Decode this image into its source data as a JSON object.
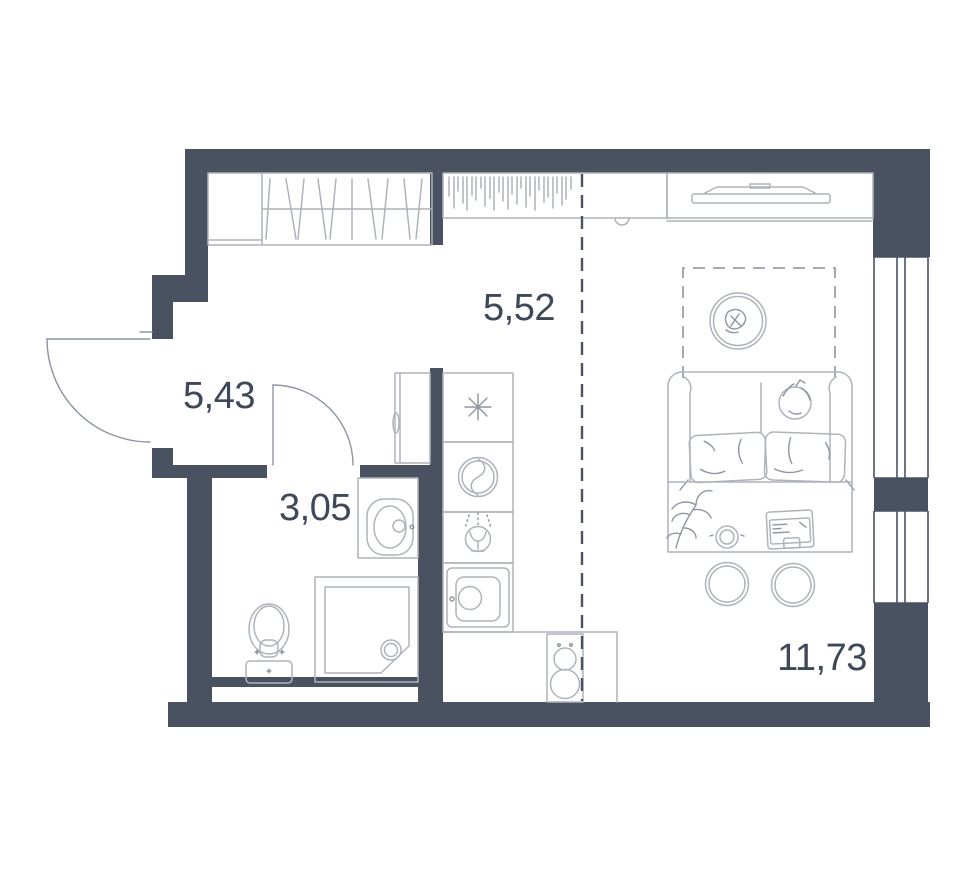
{
  "plan": {
    "type": "apartment-floor-plan",
    "colors": {
      "wall": "#4a5262",
      "furniture_line": "#aeb3ba",
      "furniture_line_dark": "#8e95a0",
      "partition_dash": "#4a5262",
      "rug_dash": "#9aa0ab",
      "label": "#3f4859",
      "background": "#ffffff"
    },
    "rooms": [
      {
        "id": "hallway",
        "area_label": "5,43"
      },
      {
        "id": "bathroom",
        "area_label": "3,05"
      },
      {
        "id": "kitchen",
        "area_label": "5,52"
      },
      {
        "id": "living-room",
        "area_label": "11,73"
      }
    ],
    "fixtures": [
      "entry-door",
      "wardrobe-with-hangers",
      "hallway-cabinet",
      "bathroom-door",
      "bathroom-sink",
      "toilet",
      "shower",
      "fridge-freezer",
      "washing-machine",
      "dishwasher",
      "kitchen-sink",
      "stove",
      "curtain-closet",
      "tv-console",
      "tv",
      "round-table",
      "rug",
      "sofa-bed",
      "pillows",
      "desk",
      "desk-plant",
      "cup",
      "laptop",
      "stool",
      "stool",
      "window",
      "window"
    ]
  }
}
